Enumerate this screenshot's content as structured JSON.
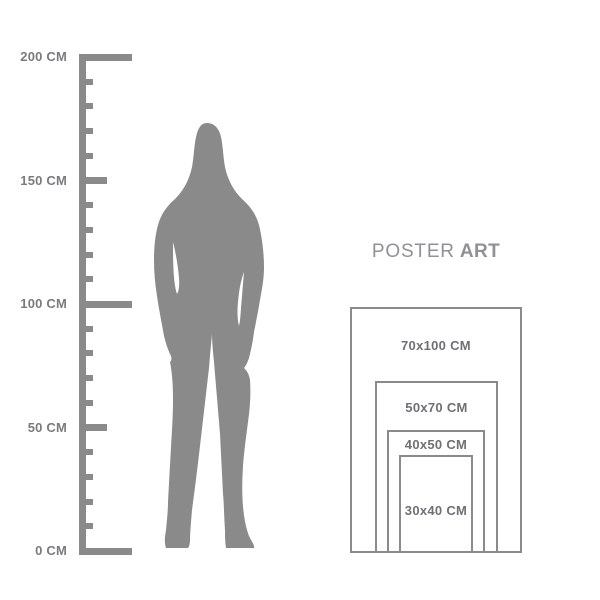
{
  "page": {
    "background": "#ffffff"
  },
  "brand": {
    "regular": "POSTER",
    "bold": "ART"
  },
  "ruler": {
    "color": "#8a8a8a",
    "label_color": "#7a7b7d",
    "min_cm": 0,
    "max_cm": 200,
    "minor_step_cm": 10,
    "medium_step_cm": 50,
    "major_step_cm": 100,
    "labels": [
      {
        "text": "200 CM",
        "cm": 200
      },
      {
        "text": "150 CM",
        "cm": 150
      },
      {
        "text": "100 CM",
        "cm": 100
      },
      {
        "text": "50 CM",
        "cm": 50
      },
      {
        "text": "0 CM",
        "cm": 0
      }
    ]
  },
  "figure": {
    "icon": "standing-woman-silhouette",
    "color": "#8a8a8a"
  },
  "poster_sizes": {
    "border_color": "#8a8a8a",
    "label_color": "#6f7073",
    "items": [
      {
        "label": "70x100 CM",
        "width_cm": 70,
        "height_cm": 100
      },
      {
        "label": "50x70 CM",
        "width_cm": 50,
        "height_cm": 70
      },
      {
        "label": "40x50 CM",
        "width_cm": 40,
        "height_cm": 50
      },
      {
        "label": "30x40 CM",
        "width_cm": 30,
        "height_cm": 40
      }
    ]
  }
}
